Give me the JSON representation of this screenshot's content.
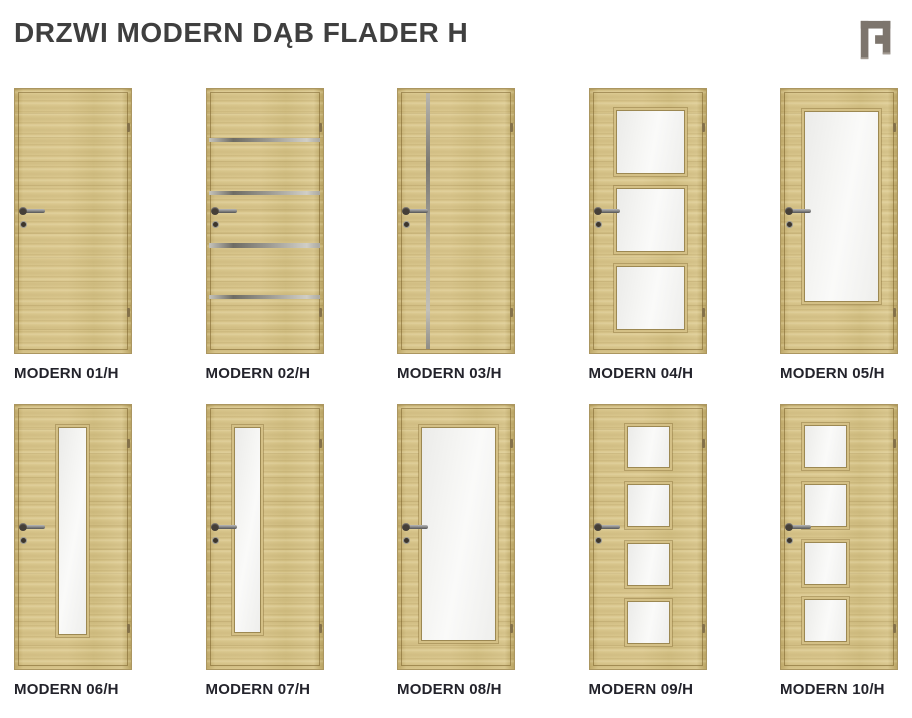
{
  "page": {
    "title": "DRZWI MODERN DĄB FLADER H",
    "background": "#ffffff"
  },
  "header": {
    "logo_icon": "door-frame-icon",
    "logo_color": "#7d756d"
  },
  "colors": {
    "title_text": "#3f3f3f",
    "label_text": "#23232b",
    "wood_base": "#d5c289",
    "wood_dark_edge": "#ab9660",
    "glass_fill": "#f3f3f1",
    "glass_frame": "#9c8852",
    "inox_strip": "#8a887f",
    "handle_metal": "#8a8a8a"
  },
  "doors": [
    {
      "id": "modern-01h",
      "label": "MODERN 01/H",
      "glazing": "plain slab, no glazing",
      "features": []
    },
    {
      "id": "modern-02h",
      "label": "MODERN 02/H",
      "glazing": "4 horizontal inox strips",
      "features": [
        {
          "type": "hstrip",
          "left": 2.5,
          "top": 18.5,
          "width": 95,
          "height": 1.6
        },
        {
          "type": "hstrip",
          "left": 2.5,
          "top": 38.5,
          "width": 95,
          "height": 1.6
        },
        {
          "type": "hstrip",
          "left": 2.5,
          "top": 58.5,
          "width": 95,
          "height": 1.6
        },
        {
          "type": "hstrip",
          "left": 2.5,
          "top": 78.0,
          "width": 95,
          "height": 1.6
        }
      ]
    },
    {
      "id": "modern-03h",
      "label": "MODERN 03/H",
      "glazing": "1 full-height vertical inox strip",
      "features": [
        {
          "type": "vstrip",
          "left": 24.5,
          "top": 1.5,
          "width": 3.2,
          "height": 97
        }
      ]
    },
    {
      "id": "modern-04h",
      "label": "MODERN 04/H",
      "glazing": "3 rectangular glass panels",
      "features": [
        {
          "type": "glass",
          "left": 23,
          "top": 8.0,
          "width": 58,
          "height": 23.5
        },
        {
          "type": "glass",
          "left": 23,
          "top": 37.5,
          "width": 58,
          "height": 23.5
        },
        {
          "type": "glass",
          "left": 23,
          "top": 67.0,
          "width": 58,
          "height": 23.5
        }
      ]
    },
    {
      "id": "modern-05h",
      "label": "MODERN 05/H",
      "glazing": "1 large glass panel",
      "features": [
        {
          "type": "glass",
          "left": 20,
          "top": 8.5,
          "width": 63,
          "height": 71.5
        }
      ]
    },
    {
      "id": "modern-06h",
      "label": "MODERN 06/H",
      "glazing": "1 narrow vertical glass light, centered-left",
      "features": [
        {
          "type": "glass",
          "left": 37,
          "top": 8.5,
          "width": 23,
          "height": 78
        }
      ]
    },
    {
      "id": "modern-07h",
      "label": "MODERN 07/H",
      "glazing": "1 narrow vertical glass light, left",
      "features": [
        {
          "type": "glass",
          "left": 24,
          "top": 8.5,
          "width": 21,
          "height": 77
        }
      ]
    },
    {
      "id": "modern-08h",
      "label": "MODERN 08/H",
      "glazing": "1 large glass panel",
      "features": [
        {
          "type": "glass",
          "left": 20,
          "top": 8.5,
          "width": 63,
          "height": 80
        }
      ]
    },
    {
      "id": "modern-09h",
      "label": "MODERN 09/H",
      "glazing": "4 square glass panels, centered",
      "features": [
        {
          "type": "glass",
          "left": 32,
          "top": 7.8,
          "width": 36,
          "height": 15.5
        },
        {
          "type": "glass",
          "left": 32,
          "top": 30.0,
          "width": 36,
          "height": 15.5
        },
        {
          "type": "glass",
          "left": 32,
          "top": 52.2,
          "width": 36,
          "height": 15.5
        },
        {
          "type": "glass",
          "left": 32,
          "top": 74.2,
          "width": 36,
          "height": 15.5
        }
      ]
    },
    {
      "id": "modern-10h",
      "label": "MODERN 10/H",
      "glazing": "4 square glass panels, left",
      "features": [
        {
          "type": "glass",
          "left": 20,
          "top": 7.5,
          "width": 35,
          "height": 15.5
        },
        {
          "type": "glass",
          "left": 20,
          "top": 30.0,
          "width": 35,
          "height": 15.5
        },
        {
          "type": "glass",
          "left": 20,
          "top": 52.0,
          "width": 35,
          "height": 15.5
        },
        {
          "type": "glass",
          "left": 20,
          "top": 73.5,
          "width": 35,
          "height": 15.5
        }
      ]
    }
  ],
  "rows": {
    "row_1_door_ids": [
      0,
      1,
      2,
      3,
      4
    ],
    "row_2_door_ids": [
      5,
      6,
      7,
      8,
      9
    ]
  }
}
